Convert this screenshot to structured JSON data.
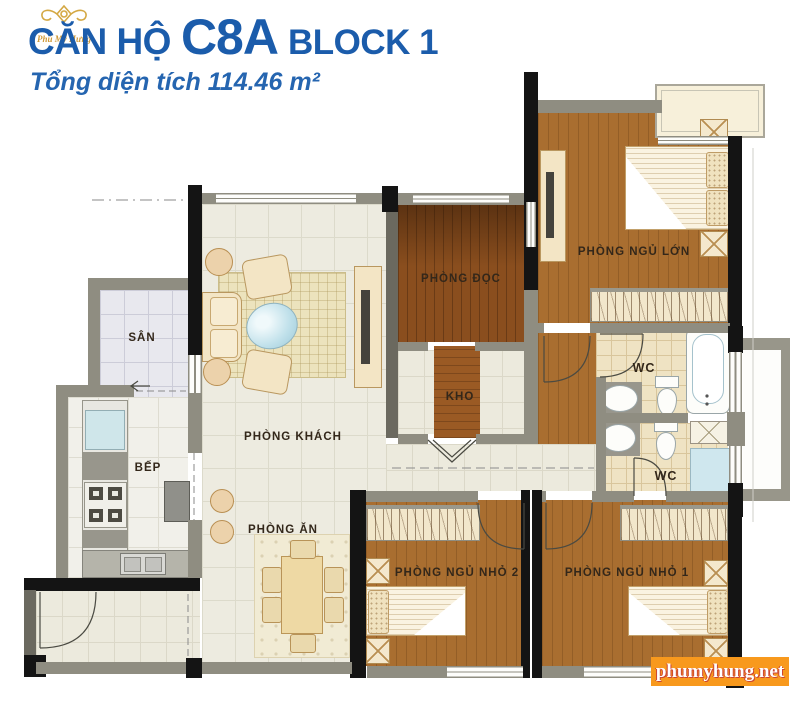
{
  "header": {
    "logo_text": "Phú Mỹ Hưng",
    "title_prefix": "CĂN HỘ",
    "title_code": "C8A",
    "title_suffix": "BLOCK 1",
    "subtitle": "Tổng diện tích 114.46 m²"
  },
  "rooms": {
    "san": {
      "label": "SÂN"
    },
    "bep": {
      "label": "BẾP"
    },
    "phong_khach": {
      "label": "PHÒNG KHÁCH"
    },
    "phong_an": {
      "label": "PHÒNG ĂN"
    },
    "phong_doc": {
      "label": "PHÒNG ĐỌC"
    },
    "kho": {
      "label": "KHO"
    },
    "phong_ngu_lon": {
      "label": "PHÒNG NGỦ LỚN"
    },
    "wc_tren": {
      "label": "WC"
    },
    "wc_duoi": {
      "label": "WC"
    },
    "phong_ngu_nho_2": {
      "label": "PHÒNG NGỦ NHỎ 2"
    },
    "phong_ngu_nho_1": {
      "label": "PHÒNG NGỦ NHỎ 1"
    }
  },
  "watermark": {
    "text": "phumyhung.net",
    "background": "#f8991d",
    "text_color": "#ffffff"
  },
  "colors": {
    "title_blue": "#1b5cab",
    "logo_gold": "#cf9a3a",
    "wood_floor": "#a96e30",
    "dark_wood_floor": "#8a4e1e",
    "tile_floor": "#edebe0",
    "wc_tile": "#efe3c3",
    "wall_black": "#141414",
    "wall_gray": "#8f8d81",
    "watermark_orange": "#f8991d"
  }
}
